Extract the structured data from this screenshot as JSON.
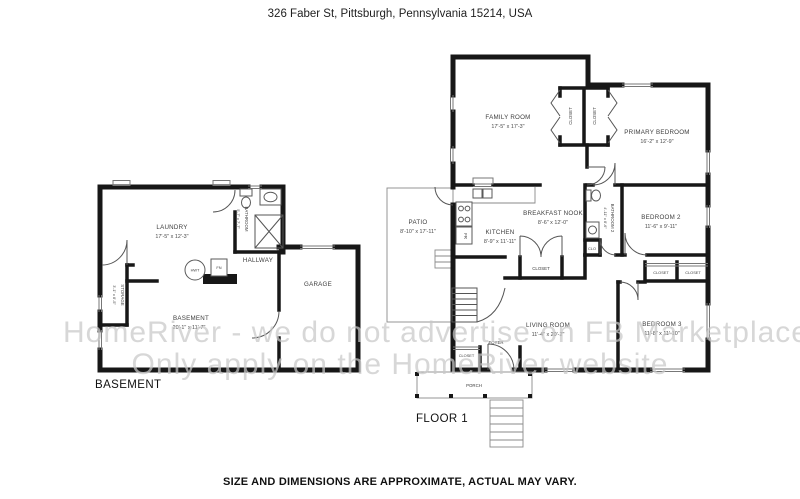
{
  "header": {
    "address": "326 Faber St, Pittsburgh, Pennsylvania 15214, USA"
  },
  "watermark": {
    "line1": "HomeRiver - we do not advertise on FB Marketplace",
    "line2": "Only apply on the HomeRiver website"
  },
  "basement": {
    "title": "BASEMENT",
    "laundry": {
      "name": "LAUNDRY",
      "dims": "17'-5\" x 12'-3\""
    },
    "bathroom": {
      "name": "BATHROOM",
      "dims": "5'-7\" x 7'-7\""
    },
    "storage": {
      "name": "STORAGE",
      "dims": "3'-1\" x 8'-5\""
    },
    "hallway": {
      "name": "HALLWAY"
    },
    "garage": {
      "name": "GARAGE"
    },
    "basement_room": {
      "name": "BASEMENT",
      "dims": "20'-1\" x 11'-7\""
    },
    "hwt": {
      "name": "HWT"
    },
    "fn": {
      "name": "FN"
    }
  },
  "floor1": {
    "title": "FLOOR 1",
    "family_room": {
      "name": "FAMILY ROOM",
      "dims": "17'-5\" x 17'-3\""
    },
    "primary_bedroom": {
      "name": "PRIMARY BEDROOM",
      "dims": "16'-2\" x 12'-9\""
    },
    "closet_left": {
      "name": "CLOSET"
    },
    "closet_right": {
      "name": "CLOSET"
    },
    "patio": {
      "name": "PATIO",
      "dims": "8'-10\" x 17'-11\""
    },
    "kitchen": {
      "name": "KITCHEN",
      "dims": "8'-9\" x 11'-11\""
    },
    "fridge": {
      "name": "FR"
    },
    "breakfast_nook": {
      "name": "BREAKFAST NOOK",
      "dims": "8'-6\" x 12'-0\""
    },
    "bathroom2": {
      "name": "BATHROOM 2",
      "dims": "4'-11\" x 8'-6\""
    },
    "bedroom2": {
      "name": "BEDROOM 2",
      "dims": "11'-6\" x 9'-11\""
    },
    "clo": {
      "name": "CLO"
    },
    "closet_kitchen": {
      "name": "CLOSET"
    },
    "closet_hall_left": {
      "name": "CLOSET"
    },
    "closet_hall_right": {
      "name": "CLOSET"
    },
    "living_room": {
      "name": "LIVING ROOM",
      "dims": "11'-4\" x 20'-2\""
    },
    "foyer": {
      "name": "FOYER"
    },
    "closet_foyer": {
      "name": "CLOSET"
    },
    "bedroom3": {
      "name": "BEDROOM 3",
      "dims": "11'-8\" x 11'-10\""
    },
    "porch": {
      "name": "PORCH"
    }
  },
  "footer": {
    "disclaimer": "SIZE AND DIMENSIONS ARE APPROXIMATE, ACTUAL MAY VARY."
  }
}
